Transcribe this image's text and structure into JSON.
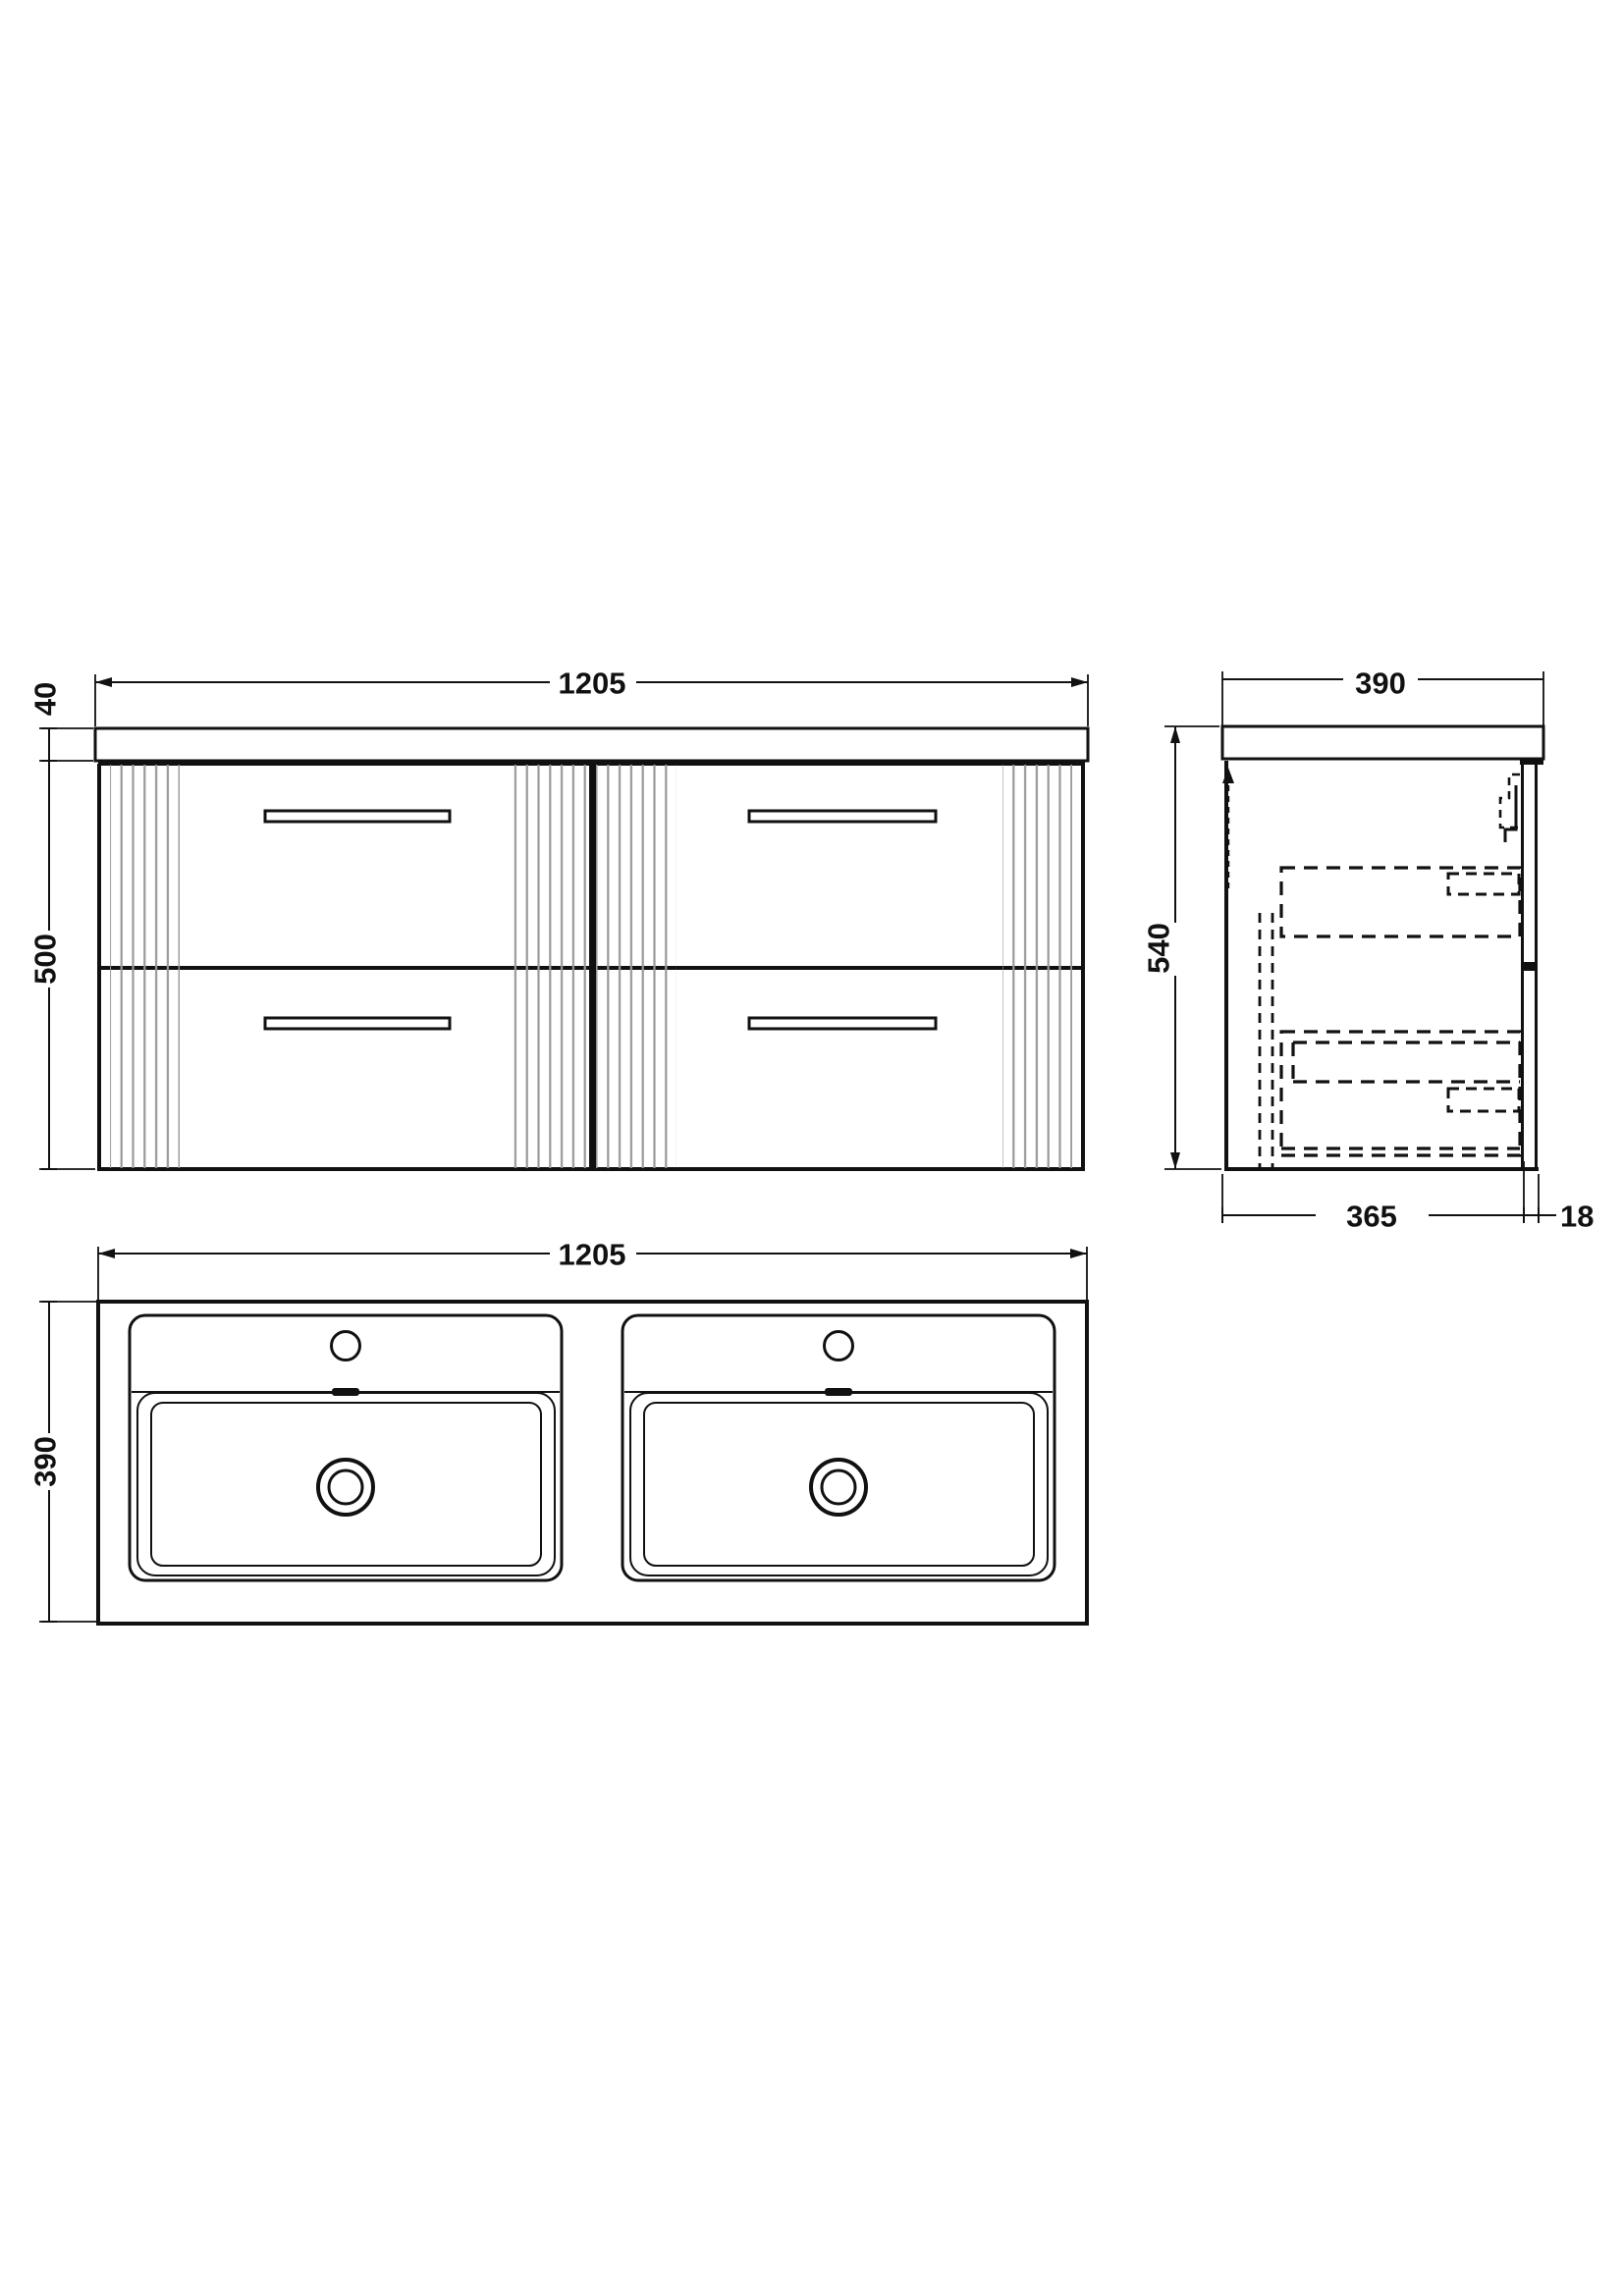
{
  "views": {
    "front": {
      "label": "front-elevation",
      "width_mm": "1205",
      "worktop_thickness_mm": "40",
      "cabinet_height_mm": "500"
    },
    "side": {
      "label": "side-elevation",
      "width_mm": "390",
      "height_mm": "540",
      "cabinet_depth_mm": "365",
      "wall_gap_mm": "18"
    },
    "plan": {
      "label": "plan-view-double-basin",
      "width_mm": "1205",
      "depth_mm": "390"
    }
  },
  "colors": {
    "line": "#111111",
    "flute": "#999999",
    "background": "#ffffff"
  }
}
